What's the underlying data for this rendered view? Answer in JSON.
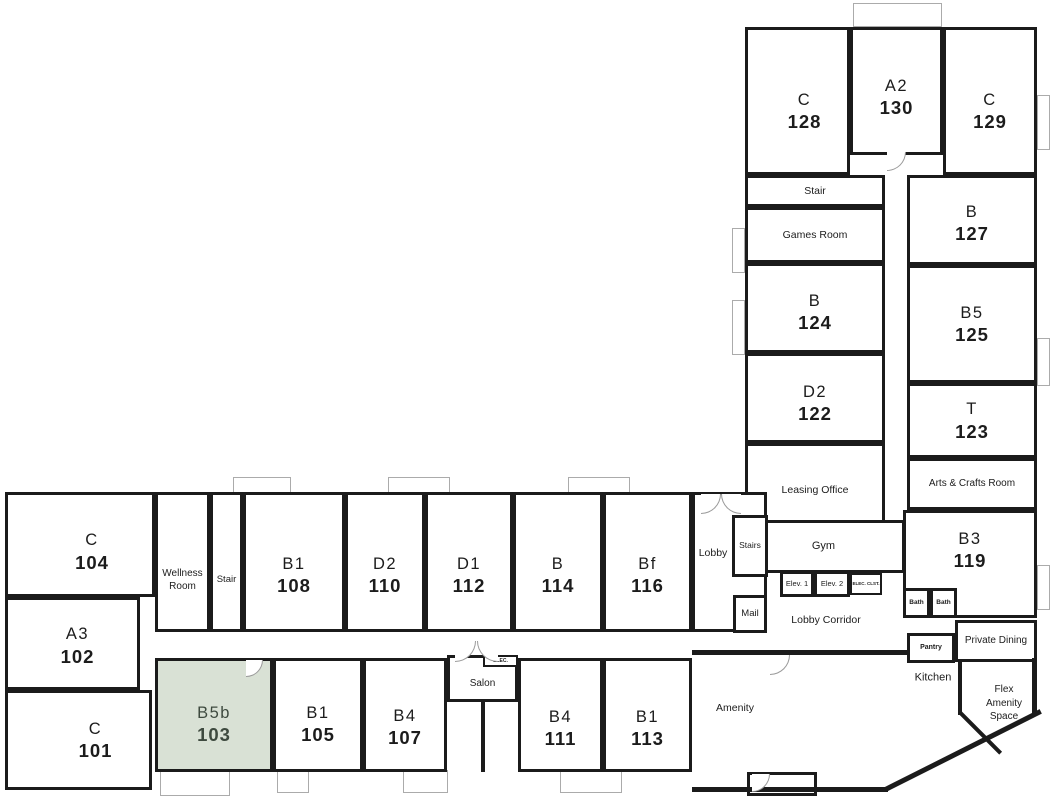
{
  "plan": {
    "width": 1051,
    "height": 799
  },
  "colors": {
    "wall": "#1b1b1b",
    "text": "#1c1c1c",
    "highlight_fill": "#d9e1d5",
    "highlight_text": "#3e4a3f",
    "balcony_border": "#ababab",
    "door_arc": "#9a9a9a"
  },
  "selected_unit": {
    "type": "B5b",
    "number": "103"
  },
  "rooms": [
    {
      "id": "c-128",
      "kind": "unit",
      "type": "C",
      "number": "128",
      "x": 745,
      "y": 27,
      "w": 105,
      "h": 148,
      "pt": 20,
      "pl": 14,
      "interactable": true
    },
    {
      "id": "a2-130",
      "kind": "unit",
      "type": "A2",
      "number": "130",
      "x": 850,
      "y": 27,
      "w": 93,
      "h": 128,
      "pt": 12,
      "interactable": true
    },
    {
      "id": "c-129",
      "kind": "unit",
      "type": "C",
      "number": "129",
      "x": 943,
      "y": 27,
      "w": 94,
      "h": 148,
      "pt": 20,
      "interactable": true
    },
    {
      "id": "stair-north",
      "kind": "common",
      "name": "Stair",
      "x": 745,
      "y": 175,
      "w": 140,
      "h": 32,
      "fs": 10.5,
      "interactable": false
    },
    {
      "id": "games-room",
      "kind": "common",
      "name": "Games Room",
      "x": 745,
      "y": 207,
      "w": 140,
      "h": 56,
      "fs": 10.5,
      "interactable": false
    },
    {
      "id": "b-127",
      "kind": "unit",
      "type": "B",
      "number": "127",
      "x": 907,
      "y": 175,
      "w": 130,
      "h": 90,
      "pt": 6,
      "interactable": true
    },
    {
      "id": "b-124",
      "kind": "unit",
      "type": "B",
      "number": "124",
      "x": 745,
      "y": 263,
      "w": 140,
      "h": 90,
      "pt": 8,
      "interactable": true
    },
    {
      "id": "b5-125",
      "kind": "unit",
      "type": "B5",
      "number": "125",
      "x": 907,
      "y": 265,
      "w": 130,
      "h": 118,
      "interactable": true
    },
    {
      "id": "d2-122",
      "kind": "unit",
      "type": "D2",
      "number": "122",
      "x": 745,
      "y": 353,
      "w": 140,
      "h": 90,
      "pt": 10,
      "interactable": true
    },
    {
      "id": "t-123",
      "kind": "unit",
      "type": "T",
      "number": "123",
      "x": 907,
      "y": 383,
      "w": 130,
      "h": 75,
      "interactable": true
    },
    {
      "id": "leasing-office",
      "kind": "common",
      "name": "Leasing Office",
      "x": 745,
      "y": 443,
      "w": 140,
      "h": 80,
      "fs": 10.5,
      "pt": 14,
      "interactable": false
    },
    {
      "id": "arts-crafts-room",
      "kind": "common",
      "name": "Arts & Crafts Room",
      "x": 907,
      "y": 458,
      "w": 130,
      "h": 52,
      "fs": 10,
      "interactable": false
    },
    {
      "id": "gym",
      "kind": "common",
      "name": "Gym",
      "x": 762,
      "y": 520,
      "w": 143,
      "h": 53,
      "fs": 11,
      "pr": 20,
      "interactable": false
    },
    {
      "id": "b3-119",
      "kind": "unit",
      "type": "B3",
      "number": "119",
      "x": 903,
      "y": 510,
      "w": 134,
      "h": 108,
      "pb": 28,
      "interactable": true
    },
    {
      "id": "c-104",
      "kind": "unit",
      "type": "C",
      "number": "104",
      "x": 5,
      "y": 492,
      "w": 150,
      "h": 105,
      "pt": 14,
      "pl": 24,
      "interactable": true
    },
    {
      "id": "wellness-room",
      "kind": "common",
      "name": "Wellness Room",
      "x": 155,
      "y": 492,
      "w": 55,
      "h": 140,
      "fs": 10,
      "pt": 36,
      "interactable": false
    },
    {
      "id": "stair-west",
      "kind": "common",
      "name": "Stair",
      "x": 210,
      "y": 492,
      "w": 33,
      "h": 140,
      "fs": 9.5,
      "pt": 36,
      "interactable": false
    },
    {
      "id": "b1-108",
      "kind": "unit",
      "type": "B1",
      "number": "108",
      "x": 243,
      "y": 492,
      "w": 102,
      "h": 140,
      "pt": 26,
      "interactable": true
    },
    {
      "id": "d2-110",
      "kind": "unit",
      "type": "D2",
      "number": "110",
      "x": 345,
      "y": 492,
      "w": 80,
      "h": 140,
      "pt": 26,
      "interactable": true
    },
    {
      "id": "d1-112",
      "kind": "unit",
      "type": "D1",
      "number": "112",
      "x": 425,
      "y": 492,
      "w": 88,
      "h": 140,
      "pt": 26,
      "interactable": true
    },
    {
      "id": "b-114",
      "kind": "unit",
      "type": "B",
      "number": "114",
      "x": 513,
      "y": 492,
      "w": 90,
      "h": 140,
      "pt": 26,
      "interactable": true
    },
    {
      "id": "bf-116",
      "kind": "unit",
      "type": "Bf",
      "number": "116",
      "x": 603,
      "y": 492,
      "w": 89,
      "h": 140,
      "pt": 26,
      "interactable": true
    },
    {
      "id": "lobby-room",
      "kind": "common",
      "name": "",
      "x": 692,
      "y": 492,
      "w": 75,
      "h": 140,
      "interactable": false
    },
    {
      "id": "stairs-lobby",
      "kind": "common",
      "name": "Stairs",
      "x": 732,
      "y": 515,
      "w": 36,
      "h": 62,
      "fs": 8.5,
      "interactable": false
    },
    {
      "id": "mail",
      "kind": "common",
      "name": "Mail",
      "x": 733,
      "y": 595,
      "w": 34,
      "h": 38,
      "fs": 9.5,
      "interactable": false
    },
    {
      "id": "elev-1",
      "kind": "service",
      "name": "Elev. 1",
      "x": 780,
      "y": 571,
      "w": 34,
      "h": 26,
      "fs": 7.5,
      "interactable": true
    },
    {
      "id": "elev-2",
      "kind": "service",
      "name": "Elev. 2",
      "x": 814,
      "y": 571,
      "w": 36,
      "h": 26,
      "fs": 7.5,
      "interactable": true
    },
    {
      "id": "elec-clst",
      "kind": "service",
      "name": "ELEC. CLST.",
      "x": 850,
      "y": 573,
      "w": 32,
      "h": 22,
      "fs": 4.5,
      "bold": true,
      "nowrap": true,
      "thin": true,
      "interactable": false
    },
    {
      "id": "bath-1",
      "kind": "service",
      "name": "Bath",
      "x": 903,
      "y": 588,
      "w": 27,
      "h": 30,
      "fs": 6.5,
      "bold": true,
      "interactable": false
    },
    {
      "id": "bath-2",
      "kind": "service",
      "name": "Bath",
      "x": 930,
      "y": 588,
      "w": 27,
      "h": 30,
      "fs": 6.5,
      "bold": true,
      "interactable": false
    },
    {
      "id": "pantry",
      "kind": "service",
      "name": "Pantry",
      "x": 907,
      "y": 633,
      "w": 48,
      "h": 30,
      "fs": 7,
      "bold": true,
      "interactable": false
    },
    {
      "id": "private-dining",
      "kind": "common",
      "name": "Private Dining",
      "x": 955,
      "y": 620,
      "w": 82,
      "h": 42,
      "fs": 10,
      "interactable": false
    },
    {
      "id": "a3-102",
      "kind": "unit",
      "type": "A3",
      "number": "102",
      "x": 5,
      "y": 597,
      "w": 135,
      "h": 93,
      "pt": 4,
      "pl": 10,
      "interactable": true
    },
    {
      "id": "c-101",
      "kind": "unit",
      "type": "C",
      "number": "101",
      "x": 5,
      "y": 690,
      "w": 147,
      "h": 100,
      "pl": 34,
      "interactable": true
    },
    {
      "id": "b5b-103",
      "kind": "unit",
      "type": "B5b",
      "number": "103",
      "x": 155,
      "y": 658,
      "w": 118,
      "h": 114,
      "pt": 18,
      "selected": true,
      "interactable": true
    },
    {
      "id": "b1-105",
      "kind": "unit",
      "type": "B1",
      "number": "105",
      "x": 273,
      "y": 658,
      "w": 90,
      "h": 114,
      "pt": 18,
      "interactable": true
    },
    {
      "id": "b4-107",
      "kind": "unit",
      "type": "B4",
      "number": "107",
      "x": 363,
      "y": 658,
      "w": 84,
      "h": 114,
      "pt": 24,
      "interactable": true
    },
    {
      "id": "salon",
      "kind": "common",
      "name": "Salon",
      "x": 447,
      "y": 655,
      "w": 71,
      "h": 47,
      "fs": 10,
      "pt": 10,
      "interactable": false
    },
    {
      "id": "elec-salon",
      "kind": "service",
      "name": "ELEC.",
      "x": 483,
      "y": 655,
      "w": 35,
      "h": 12,
      "fs": 5,
      "bold": true,
      "thin": true,
      "nowrap": true,
      "interactable": false
    },
    {
      "id": "b4-111",
      "kind": "unit",
      "type": "B4",
      "number": "111",
      "x": 518,
      "y": 658,
      "w": 85,
      "h": 114,
      "pt": 26,
      "interactable": true
    },
    {
      "id": "b1-113",
      "kind": "unit",
      "type": "B1",
      "number": "113",
      "x": 603,
      "y": 658,
      "w": 89,
      "h": 114,
      "pt": 26,
      "interactable": true
    },
    {
      "id": "vestibule",
      "kind": "common",
      "name": "",
      "x": 747,
      "y": 772,
      "w": 70,
      "h": 24,
      "interactable": false
    }
  ],
  "open_labels": [
    {
      "id": "lobby",
      "text": "Lobby",
      "x": 713,
      "y": 553,
      "fs": 10.5
    },
    {
      "id": "lobby-corridor",
      "text": "Lobby Corridor",
      "x": 826,
      "y": 620,
      "fs": 10.5
    },
    {
      "id": "kitchen",
      "text": "Kitchen",
      "x": 933,
      "y": 678,
      "fs": 11
    },
    {
      "id": "flex-amenity-space",
      "text": "Flex\nAmenity\nSpace",
      "x": 1004,
      "y": 703,
      "fs": 10
    },
    {
      "id": "amenity",
      "text": "Amenity",
      "x": 735,
      "y": 708,
      "fs": 10.5
    }
  ],
  "walls": [
    {
      "id": "amenity-top",
      "x": 692,
      "y": 650,
      "w": 216,
      "h": 5
    },
    {
      "id": "amenity-bottom",
      "x": 692,
      "y": 787,
      "w": 196,
      "h": 5
    },
    {
      "id": "corner-diagonal",
      "x": 876,
      "y": 748,
      "w": 174,
      "h": 5,
      "rot": -26.7
    },
    {
      "id": "right-lower",
      "x": 1032,
      "y": 658,
      "w": 5,
      "h": 58
    },
    {
      "id": "kitchen-divider",
      "x": 958,
      "y": 662,
      "w": 4,
      "h": 53
    },
    {
      "id": "chamfer-inner",
      "x": 952,
      "y": 731,
      "w": 57,
      "h": 4,
      "rot": 45
    },
    {
      "id": "salon-stub",
      "x": 481,
      "y": 700,
      "w": 4,
      "h": 72
    }
  ],
  "balconies": [
    {
      "id": "balcony-a2",
      "x": 853,
      "y": 3,
      "w": 89,
      "h": 24
    },
    {
      "id": "balcony-top-1",
      "x": 233,
      "y": 477,
      "w": 58,
      "h": 16
    },
    {
      "id": "balcony-top-2",
      "x": 388,
      "y": 477,
      "w": 62,
      "h": 16
    },
    {
      "id": "balcony-top-3",
      "x": 568,
      "y": 477,
      "w": 62,
      "h": 16
    },
    {
      "id": "patio-1",
      "x": 160,
      "y": 770,
      "w": 70,
      "h": 26
    },
    {
      "id": "patio-2",
      "x": 277,
      "y": 770,
      "w": 32,
      "h": 23
    },
    {
      "id": "patio-3",
      "x": 403,
      "y": 770,
      "w": 45,
      "h": 23
    },
    {
      "id": "patio-4",
      "x": 560,
      "y": 770,
      "w": 62,
      "h": 23
    },
    {
      "id": "bay-right-1",
      "x": 1037,
      "y": 95,
      "w": 13,
      "h": 55
    },
    {
      "id": "bay-right-2",
      "x": 1037,
      "y": 338,
      "w": 13,
      "h": 48
    },
    {
      "id": "bay-right-3",
      "x": 1037,
      "y": 565,
      "w": 13,
      "h": 45
    },
    {
      "id": "bay-left-1",
      "x": 732,
      "y": 228,
      "w": 13,
      "h": 45
    },
    {
      "id": "bay-left-2",
      "x": 732,
      "y": 300,
      "w": 13,
      "h": 55
    }
  ],
  "doors": [
    {
      "id": "door-lobby-1",
      "x": 701,
      "y": 494,
      "s": 20,
      "corner": "se"
    },
    {
      "id": "door-lobby-2",
      "x": 721,
      "y": 494,
      "s": 20,
      "corner": "sw"
    },
    {
      "id": "door-salon-1",
      "x": 455,
      "y": 641,
      "s": 21,
      "corner": "se"
    },
    {
      "id": "door-salon-2",
      "x": 477,
      "y": 641,
      "s": 21,
      "corner": "sw"
    },
    {
      "id": "door-a2",
      "x": 887,
      "y": 152,
      "s": 19,
      "corner": "se"
    },
    {
      "id": "door-b5b",
      "x": 246,
      "y": 660,
      "s": 17,
      "corner": "se"
    },
    {
      "id": "door-amenity",
      "x": 770,
      "y": 655,
      "s": 20,
      "corner": "se"
    },
    {
      "id": "door-vestibule",
      "x": 752,
      "y": 774,
      "s": 18,
      "corner": "se"
    }
  ]
}
